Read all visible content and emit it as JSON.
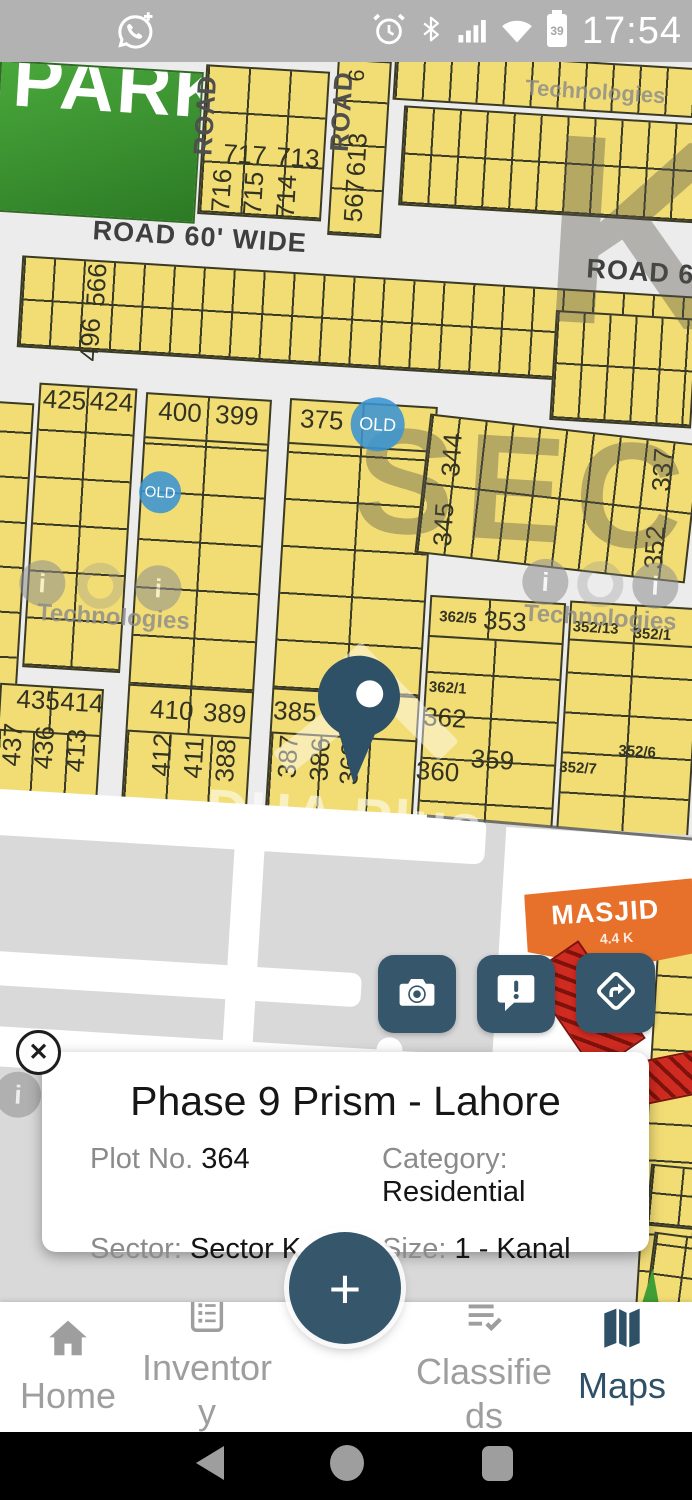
{
  "status_bar": {
    "time": "17:54",
    "battery_percent": "39",
    "icons": [
      "whatsapp-call",
      "alarm",
      "bluetooth",
      "signal",
      "wifi",
      "battery"
    ]
  },
  "map": {
    "park_label": "PARK",
    "sector_watermark": "SECTOR",
    "sector_letter": "K",
    "brand_watermark": "DHA Plus",
    "tech_watermark": "Technologies",
    "ioi": {
      "i1": "i",
      "o": "o",
      "i2": "i"
    },
    "old_badge": "OLD",
    "masjid": {
      "name": "MASJID",
      "area": "4.4 K"
    },
    "road_labels": {
      "road_v1": "ROAD",
      "road_v2": "ROAD",
      "road_60": "ROAD 60' WIDE",
      "road_6": "ROAD 6"
    },
    "plot_labels": [
      "717",
      "713",
      "716",
      "715",
      "714",
      "6",
      "613",
      "567",
      "566",
      "496",
      "425",
      "424",
      "400",
      "399",
      "375",
      "344",
      "345",
      "337",
      "352",
      "362/5",
      "353",
      "352/13",
      "352/1",
      "435",
      "414",
      "437",
      "436",
      "413",
      "410",
      "389",
      "412",
      "411",
      "388",
      "385",
      "387",
      "386",
      "363",
      "362/1",
      "362",
      "360",
      "359",
      "352/7",
      "352/6"
    ]
  },
  "action_buttons": [
    {
      "name": "camera"
    },
    {
      "name": "report"
    },
    {
      "name": "directions"
    }
  ],
  "info_card": {
    "title": "Phase 9 Prism - Lahore",
    "close_glyph": "✕",
    "plot_label": "Plot No. ",
    "plot_value": "364",
    "category_label": "Category: ",
    "category_value": "Residential",
    "sector_label": "Sector: ",
    "sector_value": "Sector K",
    "size_label": "Size: ",
    "size_value": "1 - Kanal"
  },
  "fab_label": "+",
  "bottom_nav": [
    {
      "label": "Home"
    },
    {
      "label": "Inventory"
    },
    {
      "label": "Classifieds"
    },
    {
      "label": "Maps"
    }
  ],
  "colors": {
    "accent": "#35566b",
    "plot_fill": "#f2dd74",
    "masjid": "#e7712b",
    "old_badge": "#3a94d3",
    "park": "#3f9e35",
    "statusbar": "#b2b2b2"
  }
}
